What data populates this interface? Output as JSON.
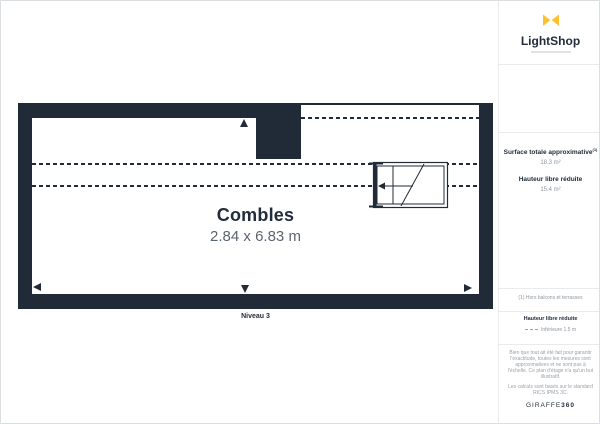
{
  "colors": {
    "wall_navy": "#212b38",
    "brand_yellow": "#fcc12c",
    "text_gray": "#8f979f"
  },
  "plan": {
    "room": {
      "name": "Combles",
      "dimensions": "2.84 x 6.83 m"
    },
    "level_label": "Niveau 3"
  },
  "sidebar": {
    "brand": {
      "name": "LightShop"
    },
    "stats": [
      {
        "label": "Surface totale approximative",
        "footnote_ref": "(1)",
        "value": "18.3 m²"
      },
      {
        "label": "Hauteur libre réduite",
        "value": "15.4 m²"
      }
    ],
    "footnote": "(1) Hors balcons et terrasses",
    "legend": {
      "title": "Hauteur libre réduite",
      "item_label": "Inférieure 1.5 m"
    },
    "disclaimer": "Bien que tout ait été fait pour garantir l'exactitude, toutes les mesures sont approximatives et ne sont pas à l'échelle. Ce plan d'étage n'a qu'un but illustratif.",
    "standard_note": "Les calculs sont basés sur le standard RICS IPMS 3C.",
    "brand_footer": {
      "prefix": "GIRAFFE",
      "suffix": "360"
    }
  }
}
